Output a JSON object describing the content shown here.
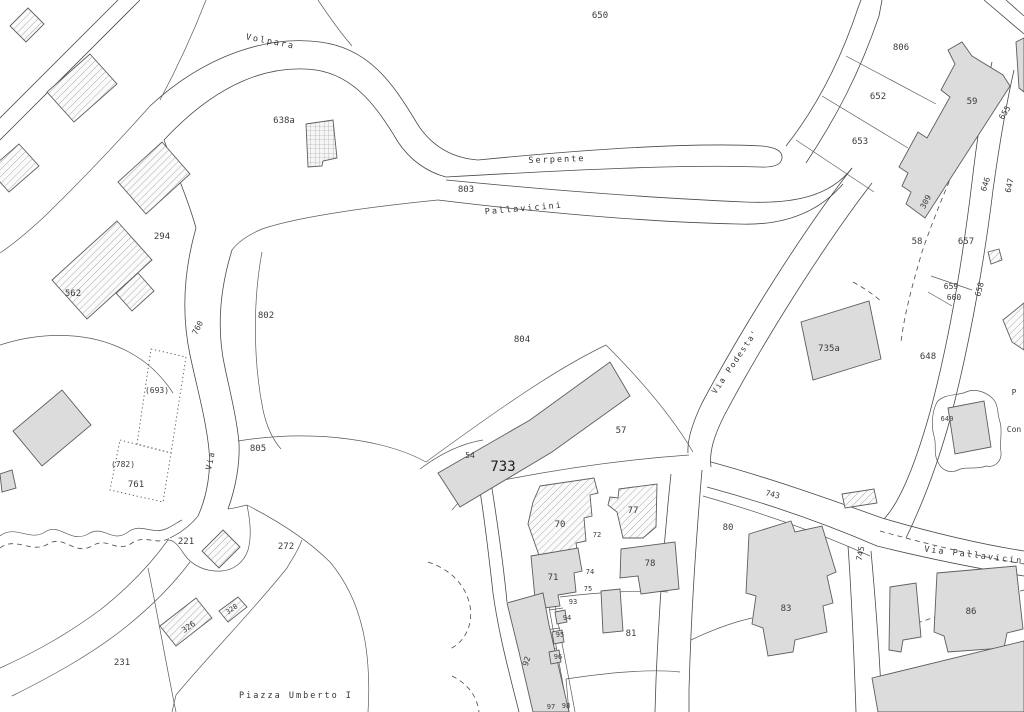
{
  "map": {
    "streets": {
      "volpara": "Volpara",
      "serpente": "Serpente",
      "pallavicini": "Pallavicini",
      "via_podesta": "Via Podesta'",
      "via_pallavicini": "Via Pallavicini",
      "via_short": "Via",
      "piazza_umberto": "Piazza Umberto I"
    },
    "parcels": {
      "p650": "650",
      "p806": "806",
      "p652": "652",
      "p653": "653",
      "p59": "59",
      "p309": "309",
      "p655": "655",
      "p646": "646",
      "p647": "647",
      "p58": "58",
      "p657": "657",
      "p659": "659",
      "p660": "660",
      "p658": "658",
      "p648": "648",
      "p640": "640",
      "p638a": "638a",
      "p803": "803",
      "p294": "294",
      "p562": "562",
      "p760": "760",
      "p802": "802",
      "p804": "804",
      "p693": "(693)",
      "p782": "(782)",
      "p761": "761",
      "p805": "805",
      "p54": "54",
      "p57": "57",
      "p733": "733",
      "p221": "221",
      "p272": "272",
      "p735a": "735a",
      "p743": "743",
      "p745": "745",
      "p80": "80",
      "p70": "70",
      "p77": "77",
      "p71": "71",
      "p72": "72",
      "p74": "74",
      "p75": "75",
      "p78": "78",
      "p83": "83",
      "p86": "86",
      "p81": "81",
      "p92": "92",
      "p93": "93",
      "p94": "94",
      "p95": "95",
      "p96": "96",
      "p97": "97",
      "p98": "98",
      "p231": "231",
      "p326": "326",
      "p328": "328"
    },
    "edge_text": {
      "p": "P",
      "con": "Con"
    },
    "colors": {
      "background": "#ffffff",
      "line": "#4a4a4a",
      "building_fill": "#dcdcdc",
      "hatch_line": "#8a8a8a",
      "label": "#3a3a3a",
      "highlight_label": "#1d1d1d"
    }
  }
}
